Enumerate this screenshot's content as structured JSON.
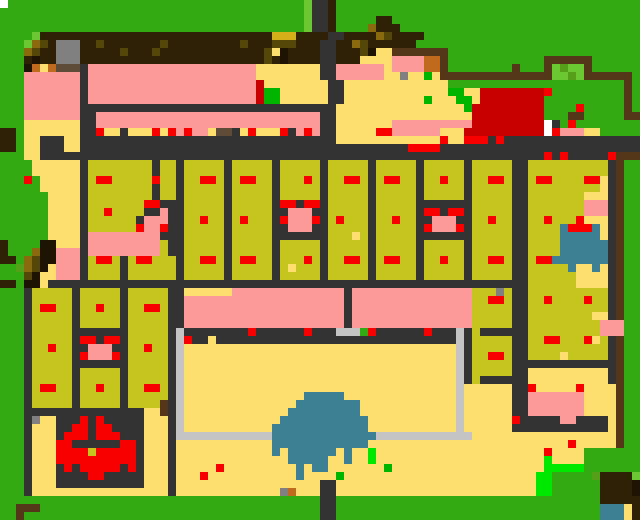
{
  "map": {
    "width_cells": 80,
    "height_cells": 65,
    "cell_size_px": 8,
    "palette": {
      "G": "#33AA11",
      "g": "#6CC832",
      "e": "#55A018",
      "E": "#00B400",
      "L": "#00E800",
      "B": "#2E2105",
      "w": "#543619",
      "o": "#554708",
      "h": "#8A6A0E",
      "d": "#D4AF1A",
      "n": "#C06A1E",
      "u": "#5F4C38",
      "y": "#FCDF6E",
      "O": "#C6C41F",
      "P": "#FC9A9A",
      "R": "#F80000",
      "r": "#C80000",
      "K": "#1D1403",
      "k": "#333333",
      "s": "#C4C4C4",
      "8": "#808080",
      "T": "#3D7F93",
      "W": "#FFFFFF"
    },
    "legend": {
      "G": "grass",
      "g": "light-foliage",
      "e": "shrub-green",
      "E": "bright-plant",
      "L": "lime-plant",
      "B": "dark-forest",
      "w": "wood-wall",
      "o": "dark-olive-spot",
      "h": "gold-brush",
      "d": "gold-block",
      "n": "ochre-block",
      "u": "umber-block",
      "y": "sand-courtyard",
      "O": "field-plot",
      "P": "pink-building",
      "R": "red-marker",
      "r": "dark-red-roof",
      "K": "black-trunk",
      "k": "stone-road",
      "s": "silver-path",
      "8": "grey-stone",
      "T": "water",
      "W": "white-dot"
    },
    "rows": [
      "WGGGGGGGGGGGGGGGGGGGGGGGGGGGGGGGGGGGGGgkkBGGGGGGGGGGGGGGGGGGGGGGGGGGGGGGGGGGGGG",
      "GGGGGGGGGGGGGGGGGGGGGGGGGGGGGGGGGGGGGGgkkBGGGGGGGGGGGGGGGGGGGGGGGGGGGGGGGGGGGGG",
      "GGGGGGGGGGGGGGGGGGGGGGGGGGGGGGGGGGGGGGgkkBGGGGGBBGGGGGGGGGGGGGGGGGGGGGGGGGGGGGG",
      "GGGGGGGGGGGGGGGGGGGGGGGGGGGGGGGGGGGGGGgkkBGGGGhBBBGGGGGGGGGGGGGGGGGGGGGGGGGGGGG",
      "GGGGgBBBBBBBBBBBBBBBBBBBBBBBBBBBBBdddBBBBkkBBBBhoBBBBGGGGGGGGGGGGGGGGGGGGGGGGGG",
      "GGGghoB888BBoBBBBBBBoBBBBBBBBBoBBBoooBBBkkBBhoBBBBBBGGGGGGGGGGGGGGGGGGGGGGGGGGG",
      "GGGhoBB888BBBBBoBBBoBBBBBBBBBBBBBoyKBBBBkkBBBoKyywwwwwwwGGGGGGGGGGGGGGGGGGGGGGG",
      "GGGBKBB888BBBBBBBBBBBBBBBBBBBBBBBoBKBBBBkkBBByyyyPPPPnnwGGGGGGGGGGGGwwwwwwGGGGGG",
      "GGGKnynuuukPPPPPPPPPPPPPPPPPPPPPyyyyyyyykkPPPPPPyPPPPnnwGGGGGGGGwGGGwgeggwGGGGGG",
      "GGGPPPPPPPkPPPPPPPPPPPPPPPPPPPPPyyyyyyyykkPPPPPPyy8yyEywwwwwwwwwwwwwggegwwwwwwG",
      "GGGPPPPPPPkPPPPPPPPPPPPPPPPPPPPPryyyyyyyykkyyyyyyyyyyyyyGGGGG",
      "GGGPPPPPPPkPPPPPPPPPPPPPPPPPPPPPrEEyyyyyykkyyyyyyyyyyyyyEEyyr",
      "GGGPPPPPPPkPPPPPPPPPPPPPPPPPPPPPrEEyyyyyykkyyyyyyyyyyEyyyEEyr",
      "GGGPPPPPPPkkkkkkkkkkkkkkkkkkkkkkkkkkkkkkkkyyyyyyyyyyyyyyyyEr",
      "GGGPPPPPPPkkPPPPPPPPPPPPPPPPPPPPPPPPPPPPkkyyyyyyyyyyyyyyyyyr",
      "GGGyyyyyyykkPPPPPPPPPPPPPPPPPPPPPPPPPPPPkkyyyyyyyPPPPPPPPPPr",
      "BBGyyyyyyykkRyykyyyRyRPRPPyuukyRyyyRkPRPkkyyyyyRRPPPPPPyyyrr",
      "BBGyykkkyykkkkkkkkkkkkkkkkkkkkkkkkkkkkkkkkyyyyyyyyyyyyyRyyRR",
      "BBGyykkkyykkkkkkkkkkkkkkkkkkkkkkkkkkkkkkkkkkkkkkkkkRRRRkkkkk",
      "GGGyykkkkkkkkkkkkkkkkkkkkkkkkkkkkkkkkkkkkkkkkkkkkkkkkkkkkkkk",
      "GGGGyyyyyykOOOOOOOOkOOkOOOOOkOOOOOkOOOOOkOOOOOkOOOOOkOOOOOkO",
      "GGGGyyyyyykOOOOOOOOkOOkOOOOOkOOOOOkOOOOOkOOOOOkOOOOOkOOOOOkO",
      "GGGRGyyyyykORROOOOOROOkOORROkORROOkOOOROkOORROkORROOkOOROOkO",
      "GGGGGyyyyykOOOOOOOOkOOkOOOOOkOOOOOkOOOOOkOOOOOkOOOOOkOOOOOkO",
      "GGGGGGyyyykOOOOOOOOkOOkOOOOOkOOOOOkOOOOOkOOOOOkOOOOOkOOOOOkO",
      "GGGGGGyyyykOOOOOOORRkkkOOOOOkOOOOOkRRkRRkOOOOOkOOOOOkkkkkkkO",
      "GGGGGGyyyykOOROOOOkkPkkOOOOOkOOOOOkkPPPkkOOOOOkOOOOOkRRkRRkO",
      "GGGGGGyyyykOOOOOOkPPPkkOOROOkOROOOkRPPPRkOROOOkOOROOkkPPPkkO",
      "GGGGGGyyyykOOOOOORPPRkkOOOOOkOOOOOkkPPPkkOOOOOkOOOOOkRPPPRkO",
      "GGGGGGyyyykPPPPPPPPPkkkOOOOOkOOOOOkkkkkkkOOOyOkOOOOOkkkkkkkO",
      "BGGGGKKyyykPPPPPPPPPOkkOOOOOkOOOOOkOOOOOkOOOOOkOOOOOkOOOOOkO",
      "BGGGhKKPPPkPPPPPPPPPOkkOOOOOkOOOOOkOOOOOkOOOOOkOOOOOkOOOOOkO",
      "BBGhoKKPPPkORROkORROOOkOORROkORROOkOOOROkOORROkORROOkOOROOkO",
      "GGehoKyPPPkOOOOkOOOOOOkOOOOOkOOOOOkOyOOOkOOOOOkOOOOOkOOOOOkO",
      "GGGoKyyPPPkOOOOkOOOOOOkOOOOOkOOOOOkOOOOOkOOOOOkOOOOOkOOOOOkO",
      "BBGKKykkkkkkkkkkkkkkkkkkkkkkkkkkkkkkkkkkkkkkkkkkkkkkkkkkkkkk",
      "GGGkOOOOOkOOOOOkOOOOOkkyyyyyyPPPPPPPPPPPPPPkPPPPPPPPPPPPPPPO",
      "GGGkOOOOOkOOOOOkOOOOOkkPPPPPPPPPPPPPPPPPPPPkPPPPPPPPPPPPPPPO",
      "GGGkORROOkOOROOkOORROkkPPPPPPPPPPPPPPPPPPPPkPPPPPPPPPPPPPPPO",
      "GGGkOOOOOkOOOOOkOOOOOkkPPPPPPPPPPPPPPPPPPPPkPPPPPPPPPPPPPPPO",
      "GGGkOOOOOkOOOOOkOOOOOkkPPPPPPPPPPPPPPPPPPPPkPPPPPPPPPPPPPPPO",
      "GGGkOOOOOkkkkkkkOOOOOkskkkkkkkkRkkkkkkRkkksssкRkkkkkkRkkkskO",
      "GGGkOOOOOkRRkRRkOOOOOksRkkykkkkkkkkkkkkkkkkkkkkkkkkkkkkkkskO",
      "GGGkOOROOkkPPPkkOOROOksyyyyyyyyyyyyyyyyyyyyyyyyyyyyyyyyyyskO",
      "GGGkOOOOOkRPPPRkOOOOOksyyyyyyyyyyyyyyyyyyyyyyyyyyyyyyyyyyskO",
      "GGGkOOOOOkkkkkkkOOOOOksyyyyyyyyyyyyyyyyyyyyyyyyyyyyyyyyyyskO",
      "GGGkOOOOOkOOOOOkOOOOOksyyyyyyyyyyyyyyyyyyyyyyyyyyyyyyyyyyskO",
      "GGGkOOOOOkOOOOOkOOOOOksyyyyyyyyyyyyyyyyyyyyyyyyyyyyyyyyyyskO",
      "GGGkORROOkOOROOkOORROksyyyyyyyyyyyyyyyyyyyyyyyyyyyyyyyyyysyy",
      "GGGkOOOOOkOOOOOkOOOOOksyyyyyyyyyyyyyyyTTTTTyyyyyyyyyyyyyysyy",
      "GGGkOOOOOkOOOOOkOOOOwksyyyyyyyyyyyyyyTTTTTTTTyyyyyyyyyyyysyy",
      "GGGkkkkkkkkkkkkkkkyywksyyyyyyyyyyyyyTTTTTTTTTyyyyyyyyyyyysyy",
      "GGGk8yykkkRkRkkkkkyyyksyyyyyyyyyyyyTTTTTTTTTTTyyyyyyyyyyysyy",
      "GGGkyyykkRRkRRkkkkyyyksyyyyyyyyyyyTTTTTTTTTTTTyyyyyyyyyyysyy",
      "GGGkyyykRRRkRRRkkkyyykssssssssssssTTTTTTTTTTTTTssssssssssssyy",
      "GGGkyyyRRkkkkkkRRkyyykyyyyyyyyyyyyTTTTTTTTTTTTyyyyyyyyyyyyyy",
      "GGGkyyyRRRRORRRRRkyyykyyyyyyyyyyyyTyTTTTTTyTyyLyyyyyyyyyyyyy",
      "GGGkyyyRRRRRRRRRRkyyykyyyyyyyyyyyyyyTTTTTyyTyyLyyyyyyyyyyyyy",
      "GGGkyyykRkRRRRRkRkyyykyyyyyRyyyyyyyyyTyTTyyyyyyyEyyyyyyyyyyy",
      "GGGkyyykkkkRRkkkkkyyykyyyRyyyyyyyyyyyTyyyyEyyyyyyyyyyyyyyyyy",
      "GGGkyyykkkkkkkkkkkyyykyyyyyyyyyyyyyyyyyykkyyyyyyyyyyyyyyyyyy",
      "GGGkyyyyyyyyyyyyyyyyykyyyyyyyyyyyyy8nyyykkyyyyyyyyyyyyyyyyyy",
      "GGGGGGGGGGGGGGGGGGGGGGGGGGGGGGGGGGGGGGGGkkGGGGGGGGGGGGGGGGGG",
      "GGwwwGGGGGGGGGGGGGGGGGGGGGGGGGGGGGGGGGGGkkGGGGGGGGGGGGGGGGGG",
      "GGwGGGGGGGGGGGGGGGGGGGGGGGGGGGGGGGGGGGGGkkGGGGGGGGGGGGGGGGGG",
      "GGwGGGGGGGGGGGGGGGGGGGGGGGGGGGGGGGGGGGGGkkGGGGGGGGGGGGGGGGGG"
    ],
    "rows_right": [
      "GGGGGGGGGGGGGGGGGGGG",
      "GGGGGGGGGGGGGGGGGGGG",
      "GGGGGGGGGGGGGGGGGGGG",
      "GGGGGGGGGGGGGGGGGGGG",
      "GGGGGGGGGGGGGGGGGGGG",
      "GGGGGGGGGGGGGGGGGGGG",
      "GGGGGGGGGGGGGGGGGGGG",
      "GGGGGGGGwwwwwwGGGGGG",
      "GGGGwGGGwgeggwGGGGGG",
      "wwwwwwwwwggegwwwwwwG",
      "GGGGGGGGGGGGGGGGGGwG",
      "rrrrrrrrRGGGGGGGGGwG",
      "rrrrrrrrGGGGGGGGGGwG",
      "rrrrrrrrGGGGRGGGGGwG",
      "rrrrrrrrGGGwwGGGGGww",
      "rrrrrrrrWkGRGGGGGGGG",
      "rrrrrrrrWRPPPyyGGGGG",
      "RkRkkkkkkkkkkkkkkkkk",
      "kkkkkkkkkkkkkkkkkkkk",
      "kkkkkkkkRkRkkkkkRwww",
      "OOOOkkOOOOOOOOOOkwGG",
      "OOOOkkOOOOOOOOOOkwGG",
      "ORROkkORROOOORRykwGG",
      "OOOOkkOOOOOOOOOykwGG",
      "OOOOkkOOOOOOOyyykwGG",
      "OOOOkkOOOOOOOPPPkwGG",
      "OOOOkkOOOOOOOPPPkwGG",
      "OROOkkOOROOORyyykwGG",
      "OOOOkkOOOOTRRRTykwGG",
      "OOOOkkOOOOTTTTTykwGG",
      "OOOOkkOOOOTTTTTTkwGG",
      "OOOOkkOOOOTTTTTTkwGG",
      "ORROkkORRTTTTTTTkwGG",
      "OOOOkkOOOOOTyyTykwGG",
      "OOOOkkOOOOOOyyyykwGG",
      "kkkkkkOOOOOOyyyykwGG",
      "OO8OkkOOOOOOOOOOkwGG",
      "ORROkkOOROOOOROOkwGG",
      "OOOOkkOOOOOOOOOOkwGG",
      "OOOOkkOOOOOOOOyykwGG",
      "OOOOkkOOOOOOOOOPPPGG",
      "kkkkkkOOOOOOOOOPPPGG",
      "OOOOkkOORROOORyOkwGG",
      "OOOOkkOOOOOOOOOOkwGG",
      "ORROkkOOOOyOOOOOkwGG",
      "OOOOkkkkkkkkkkkkkwGG",
      "OOOOkkyyyyyyyyyykwGG",
      "kkkkkkyyyyyyyyyykwGG",
      "yyyykkRyyyyyRyyyywGG",
      "yyyykkPPPPPPPyyyywGG",
      "yyyykkPPPPPPPyyyywGG",
      "yyyykkPPPPPPPyyyywGG",
      "yyyyRkkkkkPPkkkkywGG",
      "yyyykkkkkkkkkkkkywGG",
      "yyyyyyyyyyyyyyyyywGG",
      "yyyyyyyyyyyRyyyyywGG",
      "yyyyyyyyRyyyyGGGGGGG",
      "yyyyyyyyLyyyyGGGGGGG",
      "yyyyyyyyLLLLLGGGGGGG",
      "yyyyyyyLLGGGGGeBBBBg",
      "yyyyyyyLLGGGGGGBBBBK",
      "yyyyyyyLLGGGGGGBBBBK",
      "GGGGGGGGGGGGGGGBBBBB",
      "GGGGGGGGGGGGGGGTTTyB",
      "GGGGGGGGGGGGGGGTTTyB"
    ]
  }
}
